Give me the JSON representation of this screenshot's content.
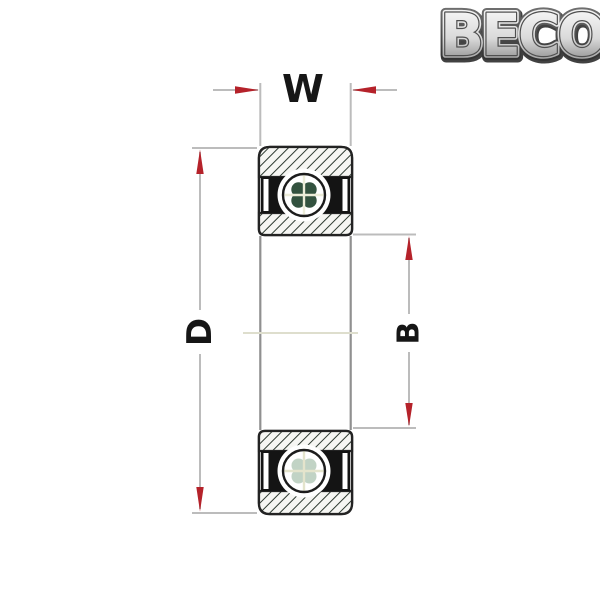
{
  "logo": {
    "text": "BECO"
  },
  "labels": {
    "width": "W",
    "outer_diameter": "D",
    "bore": "B"
  },
  "diagram_title": "Sealed deep groove ball bearing cross-section with W, D and B dimension callouts",
  "colors": {
    "background": "#ffffff",
    "arrow_red": "#b5222a",
    "dimension_line": "#bcbcbc",
    "outline": "#232323",
    "hatch_line": "#2e3a31",
    "seal_black": "#141414",
    "label_text": "#161616",
    "centerline": "#dedecd",
    "bore_line": "#909090"
  }
}
